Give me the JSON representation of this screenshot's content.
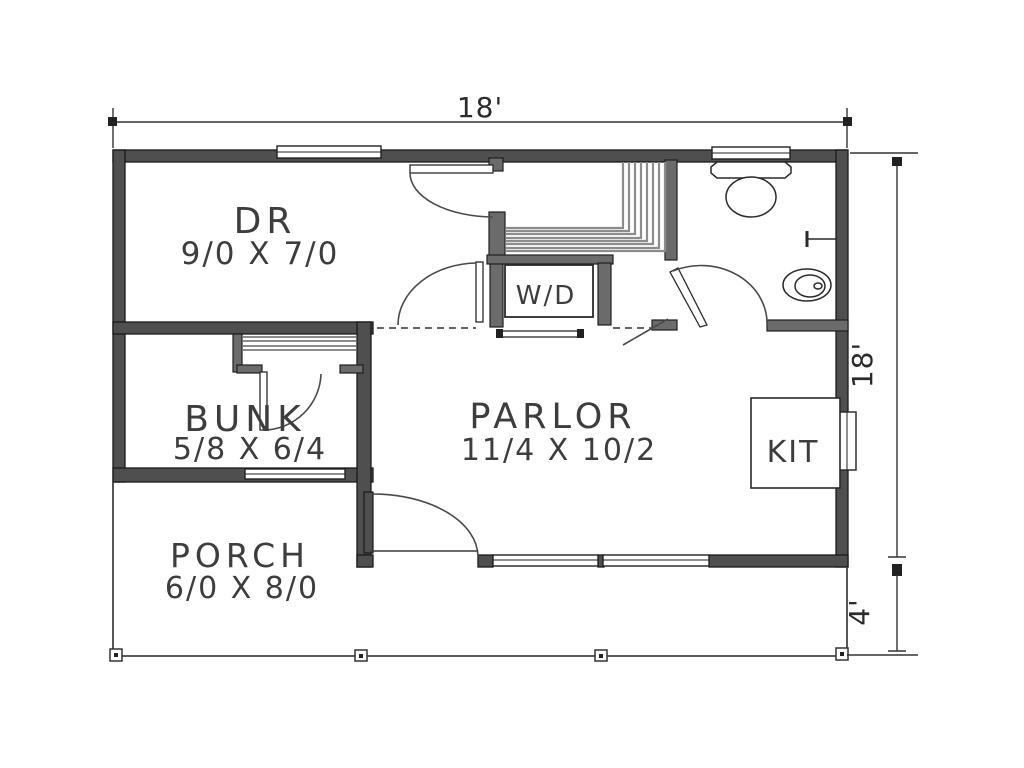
{
  "plan": {
    "type": "floor-plan",
    "background": "#ffffff",
    "wall_color": "#4f4f4f",
    "line_color": "#333333",
    "text_color": "#3d3d3d"
  },
  "rooms": [
    {
      "id": "dining",
      "name": "DR",
      "dims": "9/0 X 7/0"
    },
    {
      "id": "bunk",
      "name": "BUNK",
      "dims": "5/8 X 6/4"
    },
    {
      "id": "parlor",
      "name": "PARLOR",
      "dims": "11/4 X 10/2"
    },
    {
      "id": "porch",
      "name": "PORCH",
      "dims": "6/0 X 8/0"
    },
    {
      "id": "kitchen",
      "name": "KIT"
    },
    {
      "id": "laundry",
      "name": "W/D"
    }
  ],
  "dimensions": {
    "top_width": "18'",
    "right_height": "18'",
    "porch_depth": "4'"
  },
  "fixtures": [
    "toilet",
    "sink",
    "towel-bar",
    "stairs",
    "closet-shelves",
    "washer-dryer",
    "kitchen-counter",
    "porch-posts"
  ]
}
